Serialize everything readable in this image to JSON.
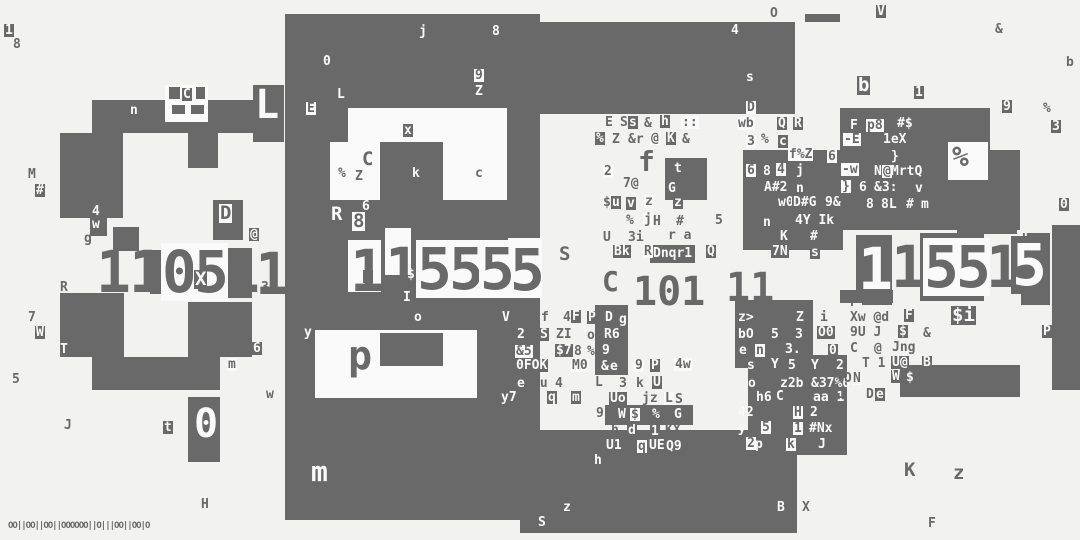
{
  "canvas": {
    "width": 1080,
    "height": 540,
    "bg_color": "#f2f2f1",
    "fg_color": "#696969",
    "white_color": "#fafafa"
  },
  "legend": {
    "blocks_fields": "[x, y, w, h, color] where color g=gray block, w=white cutout",
    "texts_fields": "[x, y, glyphs, style, size_tier] style g=gray text, w=white text, i=white text on gray box, b=gray text on white box; size_tier 0..5 (default 1)"
  },
  "blocks": [
    [
      285,
      14,
      255,
      506,
      "g"
    ],
    [
      540,
      22,
      255,
      92,
      "g"
    ],
    [
      805,
      14,
      35,
      8,
      "g"
    ],
    [
      92,
      100,
      161,
      33,
      "g"
    ],
    [
      60,
      133,
      63,
      65,
      "g"
    ],
    [
      188,
      133,
      30,
      35,
      "g"
    ],
    [
      253,
      85,
      31,
      57,
      "g"
    ],
    [
      60,
      180,
      63,
      38,
      "g"
    ],
    [
      113,
      227,
      26,
      24,
      "g"
    ],
    [
      150,
      250,
      14,
      44,
      "g"
    ],
    [
      216,
      248,
      36,
      50,
      "g"
    ],
    [
      213,
      200,
      30,
      40,
      "g"
    ],
    [
      60,
      293,
      64,
      64,
      "g"
    ],
    [
      188,
      302,
      64,
      55,
      "g"
    ],
    [
      92,
      357,
      128,
      33,
      "g"
    ],
    [
      188,
      397,
      32,
      65,
      "g"
    ],
    [
      520,
      430,
      277,
      103,
      "g"
    ],
    [
      797,
      430,
      50,
      25,
      "g"
    ],
    [
      840,
      108,
      150,
      122,
      "g"
    ],
    [
      840,
      150,
      180,
      80,
      "g"
    ],
    [
      743,
      150,
      100,
      100,
      "g"
    ],
    [
      735,
      300,
      78,
      68,
      "g"
    ],
    [
      748,
      355,
      99,
      75,
      "g"
    ],
    [
      595,
      305,
      33,
      70,
      "g"
    ],
    [
      605,
      405,
      88,
      20,
      "g"
    ],
    [
      650,
      245,
      45,
      18,
      "g"
    ],
    [
      665,
      158,
      42,
      42,
      "g"
    ],
    [
      856,
      235,
      36,
      66,
      "g"
    ],
    [
      920,
      233,
      64,
      68,
      "g"
    ],
    [
      957,
      220,
      60,
      14,
      "g"
    ],
    [
      1022,
      233,
      28,
      72,
      "g"
    ],
    [
      1052,
      225,
      28,
      165,
      "g"
    ],
    [
      900,
      365,
      120,
      32,
      "g"
    ],
    [
      840,
      290,
      53,
      13,
      "g"
    ],
    [
      1021,
      290,
      27,
      15,
      "g"
    ],
    [
      90,
      203,
      17,
      33,
      "g"
    ],
    [
      862,
      302,
      30,
      3,
      "g"
    ],
    [
      348,
      108,
      159,
      34,
      "w"
    ],
    [
      330,
      142,
      50,
      58,
      "w"
    ],
    [
      443,
      142,
      64,
      58,
      "w"
    ],
    [
      315,
      330,
      162,
      68,
      "w"
    ],
    [
      348,
      240,
      33,
      52,
      "w"
    ],
    [
      385,
      228,
      26,
      47,
      "w"
    ],
    [
      508,
      238,
      34,
      60,
      "w"
    ],
    [
      948,
      142,
      40,
      38,
      "w"
    ],
    [
      165,
      85,
      43,
      37,
      "w"
    ],
    [
      169,
      87,
      11,
      12,
      "g"
    ],
    [
      196,
      87,
      9,
      12,
      "g"
    ],
    [
      172,
      105,
      13,
      9,
      "g"
    ],
    [
      191,
      105,
      13,
      9,
      "g"
    ],
    [
      380,
      333,
      63,
      33,
      "g"
    ]
  ],
  "texts": [
    [
      4,
      24,
      "1",
      "i"
    ],
    [
      13,
      38,
      "8",
      "g"
    ],
    [
      419,
      25,
      "j",
      "w"
    ],
    [
      492,
      25,
      "8",
      "w"
    ],
    [
      323,
      55,
      "0",
      "w"
    ],
    [
      474,
      69,
      "9",
      "b"
    ],
    [
      475,
      85,
      "Z",
      "w"
    ],
    [
      337,
      88,
      "L",
      "w"
    ],
    [
      306,
      102,
      "E",
      "b"
    ],
    [
      770,
      7,
      "O",
      "g"
    ],
    [
      731,
      24,
      "4",
      "w"
    ],
    [
      876,
      5,
      "V",
      "i"
    ],
    [
      995,
      23,
      "&",
      "g"
    ],
    [
      1066,
      56,
      "b",
      "g"
    ],
    [
      746,
      71,
      "s",
      "w"
    ],
    [
      746,
      101,
      "D",
      "b"
    ],
    [
      605,
      116,
      "E",
      "g"
    ],
    [
      620,
      116,
      "S",
      "g"
    ],
    [
      628,
      116,
      "s",
      "i"
    ],
    [
      644,
      117,
      "&",
      "g"
    ],
    [
      660,
      115,
      "h",
      "i"
    ],
    [
      681,
      116,
      "::",
      "b"
    ],
    [
      737,
      117,
      "wb",
      "b"
    ],
    [
      777,
      117,
      "Q",
      "i"
    ],
    [
      793,
      117,
      "R",
      "i"
    ],
    [
      595,
      132,
      "%",
      "i"
    ],
    [
      612,
      133,
      "Z",
      "g"
    ],
    [
      628,
      133,
      "&r",
      "g"
    ],
    [
      650,
      132,
      "@",
      "b"
    ],
    [
      666,
      132,
      "K",
      "i"
    ],
    [
      682,
      133,
      "&",
      "g"
    ],
    [
      746,
      135,
      "3",
      "b"
    ],
    [
      761,
      133,
      "%",
      "g"
    ],
    [
      778,
      135,
      "c",
      "i"
    ],
    [
      788,
      148,
      "f%Z",
      "b"
    ],
    [
      827,
      150,
      "6",
      "b"
    ],
    [
      857,
      76,
      "b",
      "i",
      2
    ],
    [
      914,
      86,
      "1",
      "i"
    ],
    [
      1002,
      100,
      "9",
      "i"
    ],
    [
      1043,
      102,
      "%",
      "g"
    ],
    [
      1051,
      120,
      "3",
      "i"
    ],
    [
      850,
      119,
      "F",
      "w"
    ],
    [
      866,
      119,
      "p8",
      "b"
    ],
    [
      897,
      117,
      "#$",
      "w"
    ],
    [
      843,
      133,
      "-E",
      "b"
    ],
    [
      883,
      133,
      "1eX",
      "w"
    ],
    [
      891,
      150,
      "}",
      "w"
    ],
    [
      952,
      143,
      "%",
      "g",
      3
    ],
    [
      841,
      163,
      "-w",
      "b"
    ],
    [
      874,
      165,
      "N",
      "w"
    ],
    [
      882,
      165,
      "@",
      "b"
    ],
    [
      891,
      165,
      "MrtQ",
      "w"
    ],
    [
      841,
      180,
      "}",
      "b"
    ],
    [
      859,
      181,
      "6",
      "w"
    ],
    [
      874,
      181,
      "&3:",
      "w"
    ],
    [
      915,
      182,
      "v",
      "w"
    ],
    [
      866,
      198,
      "8",
      "w"
    ],
    [
      881,
      198,
      "8L",
      "w"
    ],
    [
      906,
      198,
      "#",
      "w"
    ],
    [
      920,
      198,
      "m",
      "i"
    ],
    [
      1059,
      198,
      "0",
      "i"
    ],
    [
      1020,
      230,
      "u",
      "w"
    ],
    [
      603,
      165,
      "2",
      "b"
    ],
    [
      638,
      148,
      "f",
      "g",
      3
    ],
    [
      673,
      162,
      "t",
      "i"
    ],
    [
      746,
      164,
      "6",
      "b"
    ],
    [
      763,
      165,
      "8",
      "w"
    ],
    [
      776,
      163,
      "4",
      "b"
    ],
    [
      796,
      164,
      "j",
      "w"
    ],
    [
      623,
      177,
      "7@",
      "g"
    ],
    [
      668,
      182,
      "G",
      "w"
    ],
    [
      763,
      181,
      "A#2",
      "i"
    ],
    [
      796,
      182,
      "n",
      "w"
    ],
    [
      603,
      196,
      "$",
      "g"
    ],
    [
      611,
      196,
      "u",
      "i"
    ],
    [
      626,
      197,
      "v",
      "i"
    ],
    [
      644,
      195,
      "z",
      "b"
    ],
    [
      673,
      196,
      "z",
      "i"
    ],
    [
      778,
      196,
      "w0",
      "w"
    ],
    [
      792,
      196,
      "D#G",
      "i"
    ],
    [
      825,
      196,
      "9&",
      "w"
    ],
    [
      626,
      214,
      "%",
      "g"
    ],
    [
      643,
      213,
      "j",
      "b"
    ],
    [
      653,
      215,
      "H",
      "g"
    ],
    [
      676,
      215,
      "#",
      "g"
    ],
    [
      715,
      214,
      "5",
      "g"
    ],
    [
      763,
      216,
      "n",
      "w"
    ],
    [
      795,
      214,
      "4Y Ik",
      "w"
    ],
    [
      603,
      231,
      "U",
      "g"
    ],
    [
      628,
      231,
      "3i",
      "g"
    ],
    [
      668,
      229,
      "r a",
      "g"
    ],
    [
      780,
      230,
      "K",
      "w"
    ],
    [
      810,
      230,
      "#",
      "w"
    ],
    [
      613,
      245,
      "Bk",
      "i"
    ],
    [
      643,
      245,
      "R",
      "b"
    ],
    [
      653,
      247,
      "Dnqr1",
      "w"
    ],
    [
      706,
      245,
      "Q",
      "i"
    ],
    [
      771,
      245,
      "7N",
      "i"
    ],
    [
      810,
      246,
      "s",
      "i"
    ],
    [
      559,
      245,
      "S",
      "g",
      2
    ],
    [
      602,
      268,
      "C",
      "g",
      3
    ],
    [
      633,
      272,
      "101",
      "g",
      4
    ],
    [
      726,
      268,
      "11",
      "g",
      4
    ],
    [
      363,
      270,
      "!",
      "i"
    ],
    [
      407,
      268,
      "$",
      "w"
    ],
    [
      403,
      291,
      "I",
      "w"
    ],
    [
      414,
      311,
      "o",
      "w"
    ],
    [
      331,
      205,
      "R",
      "w",
      2
    ],
    [
      352,
      212,
      "8",
      "b",
      2
    ],
    [
      362,
      200,
      "6",
      "w"
    ],
    [
      338,
      167,
      "%",
      "g"
    ],
    [
      355,
      170,
      "Z",
      "g"
    ],
    [
      362,
      150,
      "C",
      "g",
      2
    ],
    [
      403,
      124,
      "x",
      "i"
    ],
    [
      412,
      167,
      "k",
      "w"
    ],
    [
      475,
      167,
      "c",
      "g"
    ],
    [
      96,
      243,
      "1",
      "g",
      5
    ],
    [
      129,
      243,
      "1",
      "g",
      5
    ],
    [
      161,
      243,
      "0",
      "b",
      5
    ],
    [
      193,
      243,
      "5",
      "b",
      5
    ],
    [
      225,
      243,
      "1",
      "g",
      5
    ],
    [
      255,
      245,
      "1",
      "g",
      5
    ],
    [
      194,
      270,
      "X",
      "i",
      2
    ],
    [
      249,
      228,
      "@",
      "i"
    ],
    [
      261,
      281,
      "3",
      "g"
    ],
    [
      350,
      242,
      "1",
      "g",
      5
    ],
    [
      385,
      240,
      "1",
      "g",
      5
    ],
    [
      416,
      240,
      "5",
      "b",
      5
    ],
    [
      448,
      240,
      "5",
      "b",
      5
    ],
    [
      479,
      240,
      "5",
      "b",
      5
    ],
    [
      510,
      241,
      "5",
      "g",
      5
    ],
    [
      858,
      240,
      "1",
      "w",
      5
    ],
    [
      891,
      238,
      "1",
      "g",
      5
    ],
    [
      923,
      238,
      "5",
      "b",
      5
    ],
    [
      955,
      238,
      "5",
      "b",
      5
    ],
    [
      986,
      238,
      "1",
      "g",
      5
    ],
    [
      1011,
      236,
      "5",
      "i",
      5
    ],
    [
      28,
      168,
      "M",
      "g"
    ],
    [
      35,
      184,
      "#",
      "i"
    ],
    [
      130,
      104,
      "n",
      "w"
    ],
    [
      182,
      88,
      "C",
      "i"
    ],
    [
      92,
      205,
      "4",
      "w"
    ],
    [
      92,
      218,
      "w",
      "w"
    ],
    [
      84,
      232,
      "g",
      "g"
    ],
    [
      219,
      204,
      "D",
      "b",
      2
    ],
    [
      60,
      281,
      "R",
      "g"
    ],
    [
      28,
      311,
      "7",
      "g"
    ],
    [
      35,
      326,
      "W",
      "i"
    ],
    [
      60,
      343,
      "T",
      "w"
    ],
    [
      12,
      373,
      "5",
      "g"
    ],
    [
      252,
      342,
      "6",
      "i"
    ],
    [
      227,
      358,
      "m",
      "b"
    ],
    [
      266,
      388,
      "w",
      "g"
    ],
    [
      64,
      419,
      "J",
      "g"
    ],
    [
      163,
      421,
      "t",
      "i"
    ],
    [
      194,
      404,
      "0",
      "w",
      4
    ],
    [
      201,
      498,
      "H",
      "g"
    ],
    [
      255,
      85,
      "L",
      "w",
      4
    ],
    [
      304,
      326,
      "y",
      "w"
    ],
    [
      348,
      336,
      "p",
      "g",
      4
    ],
    [
      311,
      458,
      "m",
      "w",
      3
    ],
    [
      501,
      311,
      "V",
      "i"
    ],
    [
      541,
      311,
      "f",
      "g"
    ],
    [
      563,
      311,
      "4",
      "g"
    ],
    [
      571,
      310,
      "F",
      "i"
    ],
    [
      587,
      311,
      "P",
      "i"
    ],
    [
      605,
      311,
      "D",
      "w"
    ],
    [
      619,
      313,
      "g",
      "w"
    ],
    [
      516,
      328,
      "2",
      "i"
    ],
    [
      539,
      328,
      "S",
      "i"
    ],
    [
      556,
      328,
      "ZI",
      "g"
    ],
    [
      587,
      329,
      "o",
      "g"
    ],
    [
      604,
      328,
      "R6",
      "w"
    ],
    [
      507,
      345,
      "q",
      "g"
    ],
    [
      515,
      345,
      "&5",
      "b"
    ],
    [
      555,
      344,
      "$7",
      "i"
    ],
    [
      574,
      345,
      "8",
      "g"
    ],
    [
      587,
      345,
      "%I",
      "g"
    ],
    [
      602,
      344,
      "9",
      "w"
    ],
    [
      515,
      359,
      "0FOK",
      "i"
    ],
    [
      571,
      359,
      "M0",
      "b"
    ],
    [
      601,
      360,
      "&",
      "w"
    ],
    [
      609,
      360,
      "e",
      "i"
    ],
    [
      634,
      359,
      "9",
      "b"
    ],
    [
      650,
      359,
      "P",
      "i"
    ],
    [
      674,
      358,
      "4w",
      "b"
    ],
    [
      516,
      377,
      "e",
      "i"
    ],
    [
      532,
      377,
      "iu",
      "g"
    ],
    [
      555,
      377,
      "4",
      "g"
    ],
    [
      595,
      376,
      "L",
      "g"
    ],
    [
      619,
      377,
      "3",
      "g"
    ],
    [
      636,
      377,
      "k",
      "g"
    ],
    [
      652,
      376,
      "U",
      "i"
    ],
    [
      500,
      391,
      "y7",
      "i"
    ],
    [
      547,
      391,
      "q",
      "i"
    ],
    [
      571,
      391,
      "m",
      "i"
    ],
    [
      596,
      407,
      "9",
      "g"
    ],
    [
      609,
      392,
      "Uo",
      "i"
    ],
    [
      642,
      392,
      "jz",
      "g"
    ],
    [
      664,
      392,
      "L",
      "b"
    ],
    [
      675,
      393,
      "S",
      "g"
    ],
    [
      618,
      408,
      "W",
      "w"
    ],
    [
      630,
      408,
      "$",
      "b"
    ],
    [
      652,
      408,
      "%",
      "w"
    ],
    [
      674,
      408,
      "G",
      "w"
    ],
    [
      611,
      424,
      "h",
      "g"
    ],
    [
      627,
      424,
      "d",
      "i"
    ],
    [
      650,
      425,
      "1",
      "i"
    ],
    [
      665,
      424,
      "KX",
      "g"
    ],
    [
      605,
      439,
      "U1",
      "i"
    ],
    [
      637,
      440,
      "q",
      "b"
    ],
    [
      648,
      439,
      "UE",
      "i"
    ],
    [
      666,
      440,
      "Q9",
      "w"
    ],
    [
      594,
      454,
      "h",
      "w"
    ],
    [
      738,
      311,
      "z>",
      "w"
    ],
    [
      795,
      311,
      "Z",
      "i"
    ],
    [
      820,
      311,
      "i",
      "g"
    ],
    [
      738,
      328,
      "bO",
      "w"
    ],
    [
      771,
      328,
      "5",
      "w"
    ],
    [
      795,
      328,
      "3",
      "w"
    ],
    [
      817,
      326,
      "O0",
      "i"
    ],
    [
      738,
      344,
      "e",
      "i"
    ],
    [
      755,
      344,
      "n",
      "b"
    ],
    [
      785,
      343,
      "3.",
      "w"
    ],
    [
      828,
      344,
      "0",
      "i"
    ],
    [
      747,
      359,
      "s",
      "w"
    ],
    [
      770,
      358,
      "Y",
      "i"
    ],
    [
      788,
      359,
      "5",
      "w"
    ],
    [
      811,
      359,
      "Y",
      "w"
    ],
    [
      836,
      359,
      "2",
      "w"
    ],
    [
      748,
      377,
      "o",
      "w"
    ],
    [
      780,
      377,
      "z2b",
      "w"
    ],
    [
      811,
      377,
      "&37%0",
      "w"
    ],
    [
      756,
      391,
      "h6",
      "w"
    ],
    [
      775,
      390,
      "C",
      "i"
    ],
    [
      813,
      391,
      "aa 1",
      "w"
    ],
    [
      738,
      406,
      "42",
      "w"
    ],
    [
      793,
      406,
      "H",
      "b"
    ],
    [
      810,
      406,
      "2",
      "w"
    ],
    [
      738,
      422,
      "y",
      "w"
    ],
    [
      761,
      421,
      "5",
      "b"
    ],
    [
      793,
      422,
      "1",
      "b"
    ],
    [
      809,
      422,
      "#Nx",
      "w"
    ],
    [
      746,
      437,
      "2",
      "b"
    ],
    [
      755,
      438,
      "p",
      "w"
    ],
    [
      786,
      438,
      "k",
      "b"
    ],
    [
      818,
      438,
      "J",
      "w"
    ],
    [
      563,
      501,
      "z",
      "w"
    ],
    [
      538,
      516,
      "S",
      "w"
    ],
    [
      777,
      501,
      "B",
      "w"
    ],
    [
      802,
      501,
      "X",
      "g"
    ],
    [
      8,
      522,
      "OO||OO||OO||OOOOOO||O|||OO||OO|O",
      "g",
      0
    ],
    [
      850,
      296,
      "P",
      "g"
    ],
    [
      850,
      311,
      "Xw @d",
      "g"
    ],
    [
      904,
      309,
      "F",
      "i"
    ],
    [
      951,
      306,
      "$i",
      "i",
      2
    ],
    [
      850,
      326,
      "9U J",
      "g"
    ],
    [
      898,
      325,
      "$",
      "i"
    ],
    [
      923,
      327,
      "&",
      "g"
    ],
    [
      1042,
      325,
      "P",
      "i"
    ],
    [
      850,
      342,
      "C",
      "g"
    ],
    [
      874,
      342,
      "@",
      "g"
    ],
    [
      892,
      341,
      "Jng",
      "g"
    ],
    [
      862,
      357,
      "T 1",
      "g"
    ],
    [
      891,
      356,
      "U@",
      "i"
    ],
    [
      922,
      356,
      "B",
      "i"
    ],
    [
      836,
      372,
      "%O",
      "g"
    ],
    [
      852,
      372,
      "N",
      "b"
    ],
    [
      891,
      370,
      "W",
      "i"
    ],
    [
      906,
      371,
      "$",
      "w"
    ],
    [
      838,
      388,
      "1",
      "g"
    ],
    [
      866,
      388,
      "D",
      "g"
    ],
    [
      875,
      388,
      "e",
      "i"
    ],
    [
      904,
      461,
      "K",
      "g",
      2
    ],
    [
      953,
      464,
      "z",
      "g",
      2
    ],
    [
      928,
      517,
      "F",
      "g"
    ]
  ]
}
